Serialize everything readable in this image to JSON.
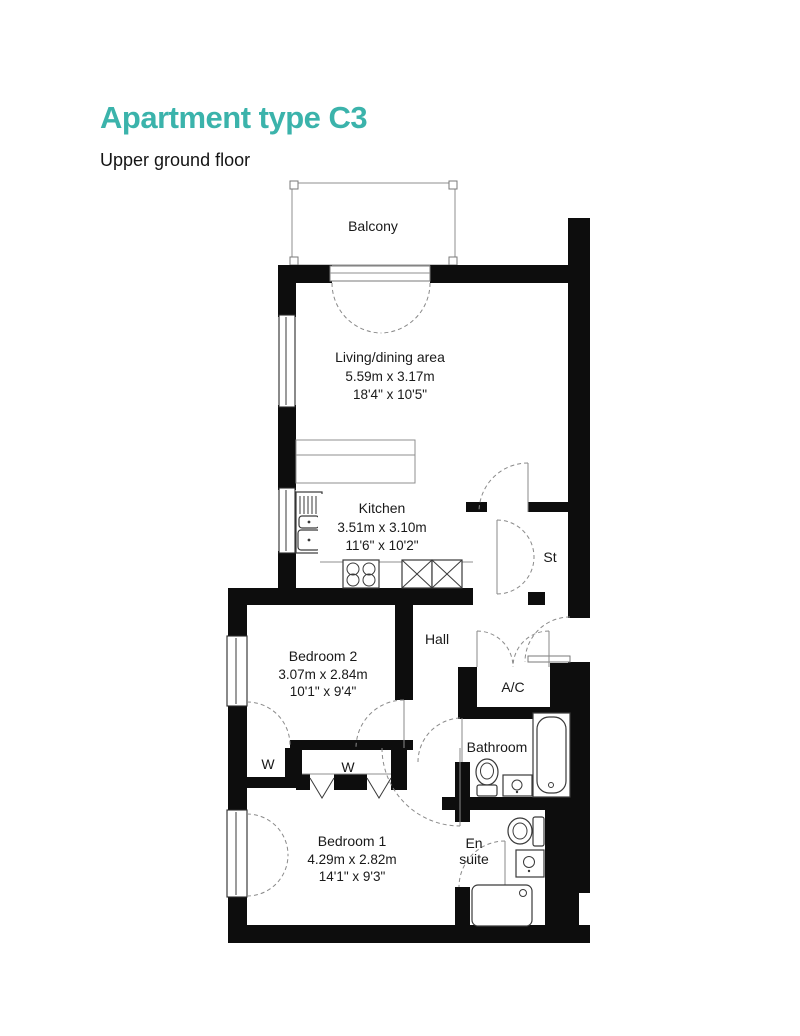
{
  "header": {
    "title": "Apartment type C3",
    "subtitle": "Upper ground floor"
  },
  "colors": {
    "accent": "#3bb3ab",
    "wall": "#0d0d0d"
  },
  "rooms": {
    "balcony": {
      "name": "Balcony"
    },
    "living": {
      "name": "Living/dining area",
      "metric": "5.59m x 3.17m",
      "imperial": "18'4\" x 10'5\""
    },
    "kitchen": {
      "name": "Kitchen",
      "metric": "3.51m x 3.10m",
      "imperial": "11'6\" x 10'2\""
    },
    "storage": {
      "name": "St"
    },
    "hall": {
      "name": "Hall"
    },
    "bedroom2": {
      "name": "Bedroom 2",
      "metric": "3.07m x 2.84m",
      "imperial": "10'1\" x 9'4\""
    },
    "ac": {
      "name": "A/C"
    },
    "bathroom": {
      "name": "Bathroom"
    },
    "wardrobe1": {
      "name": "W"
    },
    "wardrobe2": {
      "name": "W"
    },
    "bedroom1": {
      "name": "Bedroom 1",
      "metric": "4.29m x 2.82m",
      "imperial": "14'1\" x 9'3\""
    },
    "ensuite": {
      "name_line1": "En",
      "name_line2": "suite"
    }
  }
}
